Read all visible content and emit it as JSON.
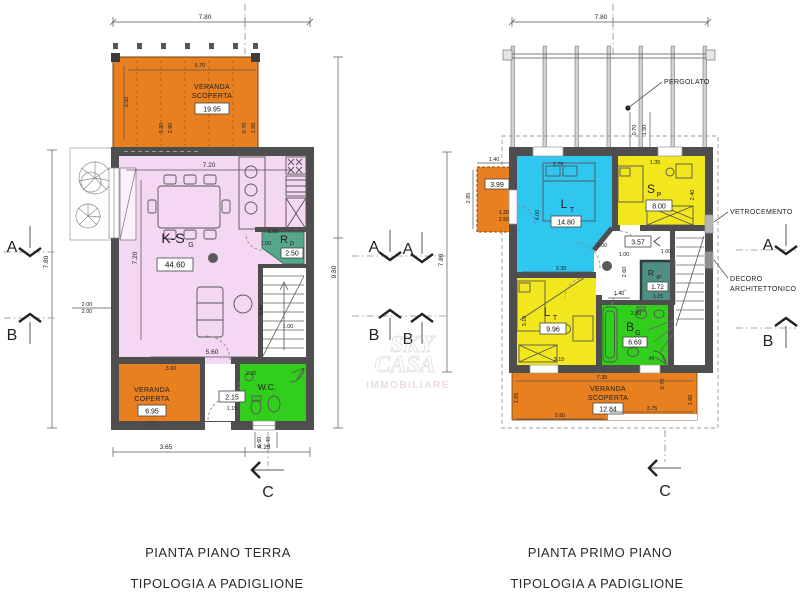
{
  "captions": {
    "gf_line1": "PIANTA PIANO TERRA",
    "gf_line2": "TIPOLOGIA A PADIGLIONE",
    "ff_line1": "PIANTA PRIMO PIANO",
    "ff_line2": "TIPOLOGIA A PADIGLIONE"
  },
  "watermark": {
    "w1": "SKY",
    "w2": "CASA",
    "w3": "IMMOBILIARE"
  },
  "annotations": {
    "pergolato": "PERGOLATO",
    "vetrocemento": "VETROCEMENTO",
    "decoro1": "DECORO",
    "decoro2": "ARCHITETTONICO"
  },
  "markers": {
    "a": "A",
    "b": "B",
    "c": "C"
  },
  "colors": {
    "orange": "#E9801F",
    "pink": "#F3D7F3",
    "cyan": "#2FC6EF",
    "yellow": "#F1E71C",
    "green": "#31CE1B",
    "teal": "#55A78C",
    "teal_dark": "#4E8F85",
    "wall": "#4E4E4E"
  },
  "ground_floor": {
    "rooms": {
      "veranda_scoperta": {
        "line1": "VERANDA",
        "line2": "SCOPERTA",
        "area": "19.95"
      },
      "kitchen_living": {
        "label": "K-S",
        "sub": "G",
        "area": "44.60"
      },
      "ripostiglio": {
        "label": "R",
        "sub": "P",
        "area": "2.50"
      },
      "wc": {
        "label": "W.C."
      },
      "corridor": {
        "area": "2.15"
      },
      "veranda_coperta": {
        "line1": "VERANDA",
        "line2": "COPERTA",
        "area": "6.95"
      }
    },
    "dims": {
      "top": "7.80",
      "left": "7.80",
      "right": "9.80",
      "bottom1": "3.65",
      "bottom2": "4.15",
      "bs1": "0.60",
      "bs2": "1.40",
      "ls1": "2.00",
      "ls2": "2.00",
      "vs_w": "5.70",
      "vs_h": "3.50",
      "vss1": "3.20",
      "vss2": "2.90",
      "vss3": "0.70",
      "vss4": "1.50",
      "room_w": "7.20",
      "room_h": "7.20",
      "room_b": "5.60",
      "stair_h": "3.60",
      "stair_w": "1.00",
      "rp_w": "1.90",
      "rp_h": "1.00",
      "cor_w": "1.15",
      "cor_t": "3.60",
      "wc_t": "2.30"
    }
  },
  "first_floor": {
    "rooms": {
      "balcony": {
        "area": "3.99"
      },
      "bedroom1": {
        "label": "L",
        "sub": "T",
        "area": "14.80"
      },
      "bedroom2": {
        "label": "S",
        "sub": "P",
        "area": "8.00"
      },
      "hallway": {
        "area": "3.57"
      },
      "ripostiglio": {
        "label": "R",
        "sub": "IP",
        "area": "1.72"
      },
      "bedroom3": {
        "label": "L",
        "sub": "T",
        "area": "9.96"
      },
      "bathroom": {
        "label": "B",
        "sub": "G",
        "area": "6.69"
      },
      "veranda_scoperta": {
        "line1": "VERANDA",
        "line2": "SCOPERTA",
        "area": "12.84"
      }
    },
    "dims": {
      "top": "7.80",
      "left": "7.80",
      "ps1": "0.70",
      "ps2": "1.50",
      "bal_w": "1.40",
      "bal_h": "2.85",
      "bal_s1": "1.20",
      "bal_s2": "2.50",
      "b1_w": "3.75",
      "b1_h": "4.00",
      "b1_b": "3.35",
      "b1_d": "1.00",
      "b2_w": "1.35",
      "b2_h": "2.40",
      "hall1": "1.00",
      "hall2": "1.00",
      "hall_h": "2.60",
      "hall_b": "1.40",
      "rip_w": "1.15",
      "b3_h": "3.10",
      "b3_b": "3.15",
      "bath_w": "2.80",
      "bath_s": ".45",
      "ver_t": "7.35",
      "ver_b1": "3.50",
      "ver_b2": "3.75",
      "ver_l": "1.85",
      "ver_r": "1.60",
      "ver_s": "0.70"
    }
  }
}
